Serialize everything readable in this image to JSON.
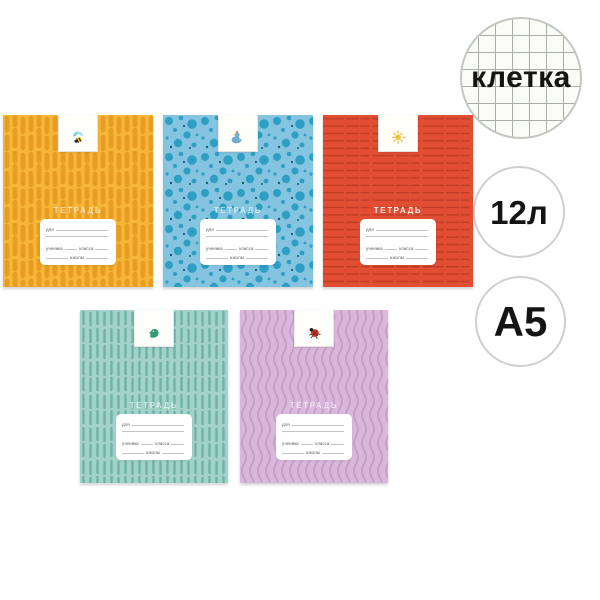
{
  "badges": {
    "paper_type": {
      "label": "клетка",
      "background": "#FBFCF7",
      "grid_line_color": "#A7AEA6",
      "border_color": "#C3C7C2",
      "text_color": "#141414"
    },
    "sheet_count": {
      "label": "12л",
      "background": "#FFFFFF",
      "border_color": "#CDD0CC",
      "text_color": "#141414"
    },
    "format": {
      "label": "А5",
      "background": "#FFFFFF",
      "border_color": "#CDD0CC",
      "text_color": "#141414"
    }
  },
  "label_card": {
    "title": "ТЕТРАДЬ",
    "for_label": "для",
    "student_label": "ученика",
    "class_label": "класса",
    "school_label": "школы"
  },
  "notebooks": [
    {
      "name": "yellow cover with vertical strokes",
      "icon": "bee",
      "colors": {
        "base": "#F6B637",
        "pattern": "#E89C24"
      }
    },
    {
      "name": "blue cover with dots",
      "icon": "crowned-bird",
      "colors": {
        "base": "#84C4E0",
        "pattern": "#2C9FC3",
        "pattern_dark": "#10607A"
      }
    },
    {
      "name": "red cover with horizontal lines",
      "icon": "sun",
      "colors": {
        "base": "#E14E33",
        "pattern": "#BC3A22"
      }
    },
    {
      "name": "teal cover with vertical dashes",
      "icon": "green-bird",
      "colors": {
        "base": "#A3D2C9",
        "pattern": "#6FB3A8"
      }
    },
    {
      "name": "lilac cover with wavy lines",
      "icon": "ladybug",
      "colors": {
        "base": "#DAB8DC",
        "pattern": "#C59DC9"
      }
    }
  ]
}
